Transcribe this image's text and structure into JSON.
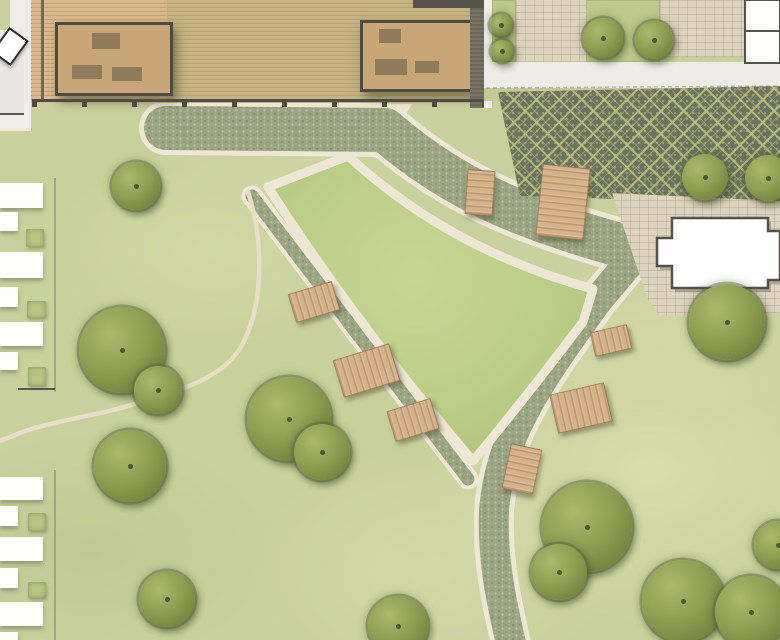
{
  "map": {
    "w": 780,
    "h": 640,
    "colors": {
      "grass": "#c9d19c",
      "central_lawn": "#bbcd85",
      "path_cream": "#efe7d5",
      "cobble": "#9ba585",
      "plaza_dark": "#6d7260",
      "plaza_light": "#bbc47e",
      "deck_wood": "#d0ad80",
      "building_tan": "#c9a678",
      "bench_wood": "#d6b189",
      "tree_green": "#8f9e52",
      "paver_beige": "#ddd3be",
      "footprint_white": "#fdfdfc"
    },
    "ground_paths": [
      {
        "name": "deck-apron-path",
        "kind": "fill",
        "d": "M168,104 L412,104 L400,124 L168,126 Z",
        "fill": "#efe7d5"
      },
      {
        "name": "walkway-top-edge",
        "kind": "stroke",
        "d": "M166,128 L385,130 C425,165 470,192 520,212 C560,228 602,241 650,253",
        "stroke": "#efe7d5",
        "w": 54
      },
      {
        "name": "walkway-east-edge",
        "kind": "stroke",
        "d": "M640,250 L598,300 C532,390 500,440 494,510 C492,560 501,600 512,648",
        "stroke": "#efe7d5",
        "w": 40
      },
      {
        "name": "walkway-west-edge",
        "kind": "stroke",
        "d": "M252,196 L468,479",
        "stroke": "#efe7d5",
        "w": 21
      },
      {
        "name": "walkway-top-cobble",
        "kind": "stroke",
        "d": "M166,128 L385,130 C425,165 470,192 520,212 C560,228 602,241 650,253",
        "stroke": "url(#cobble)",
        "w": 44
      },
      {
        "name": "walkway-east-cobble",
        "kind": "stroke",
        "d": "M640,250 L598,300 C532,390 500,440 494,510 C492,560 501,600 512,648",
        "stroke": "url(#cobble)",
        "w": 30
      },
      {
        "name": "walkway-west-cobble",
        "kind": "stroke",
        "d": "M252,196 L468,479",
        "stroke": "url(#cobble)",
        "w": 13
      },
      {
        "name": "garden-path",
        "kind": "stroke",
        "d": "M248,192 C262,235 266,300 242,345 C222,382 168,393 128,406 C94,416 52,421 20,433 L0,441",
        "stroke": "#e9ddc6",
        "w": 4.5
      },
      {
        "name": "central-lawn",
        "kind": "both",
        "d": "M268,187 L348,156 Q450,250 593,289 L583,322 Q520,405 473,461 Q356,324 268,187 Z",
        "fill": "url(#lawnGrad)",
        "stroke": "#efe7d5",
        "w": 9
      }
    ],
    "deck": {
      "x": 30,
      "y": 0,
      "w": 457,
      "h": 103,
      "green_zone": {
        "x": 167,
        "y": 0,
        "w": 303,
        "h": 103
      },
      "top_band": {
        "x": 413,
        "y": 0,
        "w": 74,
        "h": 8
      },
      "beam": {
        "x": 41,
        "y": 0,
        "w": 3,
        "h": 102
      },
      "edge": {
        "x": 470,
        "y": 8,
        "w": 14,
        "h": 100
      },
      "posts": {
        "x": 32,
        "y": 99,
        "w": 455
      },
      "buildings": [
        {
          "x": 55,
          "y": 22,
          "w": 112,
          "h": 68,
          "items": [
            [
              34,
              8,
              28,
              16
            ],
            [
              14,
              40,
              30,
              14
            ],
            [
              54,
              42,
              30,
              14
            ]
          ]
        },
        {
          "x": 360,
          "y": 20,
          "w": 110,
          "h": 66,
          "items": [
            [
              16,
              6,
              22,
              14
            ],
            [
              12,
              36,
              32,
              16
            ],
            [
              52,
              38,
              24,
              12
            ]
          ]
        }
      ]
    },
    "entry": {
      "gray": {
        "x": 0,
        "y": 30,
        "w": 24,
        "h": 86
      },
      "wall_line": {
        "x": 0,
        "y": 113,
        "w": 24,
        "h": 2
      },
      "lower_white": {
        "x": 0,
        "y": 115,
        "w": 24,
        "h": 16
      },
      "top_white": {
        "x": 10,
        "y": 0,
        "w": 14,
        "h": 30
      },
      "gap_col": {
        "x": 24,
        "y": 0,
        "w": 7,
        "h": 131
      },
      "sign": {
        "cx": 8,
        "cy": 44,
        "w": 20,
        "h": 27,
        "rot": 36
      }
    },
    "north_east": {
      "walk_col": {
        "x": 484,
        "y": 0,
        "w": 8,
        "h": 108
      },
      "beds": [
        {
          "x": 492,
          "y": 0,
          "w": 24,
          "h": 62
        },
        {
          "x": 586,
          "y": 0,
          "w": 74,
          "h": 62
        }
      ],
      "pavers": [
        {
          "x": 516,
          "y": 0,
          "w": 70,
          "h": 62
        },
        {
          "x": 660,
          "y": 0,
          "w": 85,
          "h": 57
        }
      ],
      "sidewalk": {
        "x": 484,
        "y": 62,
        "w": 296,
        "h": 26
      },
      "lawn_strip": {
        "x": 484,
        "y": 88,
        "w": 296,
        "h": 13
      },
      "plaza": {
        "x": 498,
        "y": 86,
        "w": 282,
        "h": 118,
        "clip": "polygon(0px 6px, 282px 0px, 282px 118px, 22px 110px)"
      }
    },
    "east_pavers": {
      "x": 612,
      "y": 193,
      "w": 168,
      "h": 127,
      "clip": "polygon(0px 0px, 168px 8px, 168px 120px, 48px 123px, 36px 107px)"
    },
    "overlay_paths": [
      {
        "name": "east-building-footprint",
        "d": "M672,218 L768,218 L768,231 L780,231 L780,280 L768,280 L768,288 L672,288 L672,266 L657,266 L657,238 L672,238 Z",
        "fill": "#fefefe",
        "stroke": "#54524a",
        "w": 2.5,
        "shadow": true
      },
      {
        "name": "corner-building-footprint",
        "d": "M745,0 L780,0 L780,63 L745,63 Z",
        "fill": "#fdfdfb",
        "stroke": "#57554c",
        "w": 2
      },
      {
        "name": "corner-building-wall",
        "d": "M745,31 L780,31",
        "stroke": "#57554c",
        "w": 2
      },
      {
        "name": "sidewalk-joint",
        "d": "M486,88 L780,86",
        "stroke": "rgba(110,110,100,.4)",
        "w": 1.5,
        "dash": "4 3"
      }
    ],
    "housing": {
      "edge_line": {
        "x": 54,
        "ranges": [
          [
            178,
            392
          ],
          [
            470,
            640
          ]
        ]
      },
      "groups": [
        {
          "rows": [
            [
              183,
              25,
              43
            ],
            [
              212,
              19,
              18
            ],
            [
              252,
              26,
              43
            ],
            [
              287,
              20,
              18
            ],
            [
              322,
              24,
              43
            ],
            [
              352,
              18,
              18
            ]
          ]
        },
        {
          "rows": [
            [
              477,
              23,
              43
            ],
            [
              506,
              20,
              18
            ],
            [
              537,
              24,
              43
            ],
            [
              568,
              20,
              18
            ],
            [
              602,
              24,
              43
            ],
            [
              632,
              8,
              18
            ]
          ]
        }
      ],
      "bushes": [
        [
          26,
          229,
          18,
          18
        ],
        [
          27,
          301,
          19,
          17
        ],
        [
          28,
          367,
          18,
          19
        ],
        [
          28,
          513,
          18,
          18
        ],
        [
          28,
          582,
          18,
          16
        ]
      ],
      "sep_lines": [
        [
          18,
          388,
          37
        ]
      ]
    },
    "benches": [
      [
        313,
        301,
        44,
        28,
        -17
      ],
      [
        365,
        369,
        57,
        37,
        -17
      ],
      [
        412,
        419,
        44,
        30,
        -17
      ],
      [
        479,
        191,
        26,
        43,
        4
      ],
      [
        562,
        201,
        46,
        70,
        6
      ],
      [
        610,
        339,
        36,
        23,
        -13
      ],
      [
        580,
        407,
        54,
        38,
        -13
      ],
      [
        521,
        468,
        30,
        44,
        12
      ]
    ],
    "trees": [
      [
        136,
        186,
        24
      ],
      [
        122,
        350,
        43
      ],
      [
        158,
        390,
        24
      ],
      [
        130,
        466,
        36
      ],
      [
        167,
        599,
        28
      ],
      [
        289,
        419,
        42
      ],
      [
        322,
        452,
        28
      ],
      [
        398,
        626,
        30
      ],
      [
        587,
        527,
        45
      ],
      [
        559,
        572,
        28
      ],
      [
        683,
        601,
        41
      ],
      [
        751,
        612,
        36
      ],
      [
        778,
        545,
        24
      ],
      [
        705,
        177,
        23
      ],
      [
        768,
        178,
        23
      ],
      [
        501,
        25,
        11
      ],
      [
        502,
        51,
        11
      ],
      [
        603,
        38,
        20
      ],
      [
        654,
        40,
        19
      ],
      [
        727,
        322,
        38
      ]
    ]
  }
}
